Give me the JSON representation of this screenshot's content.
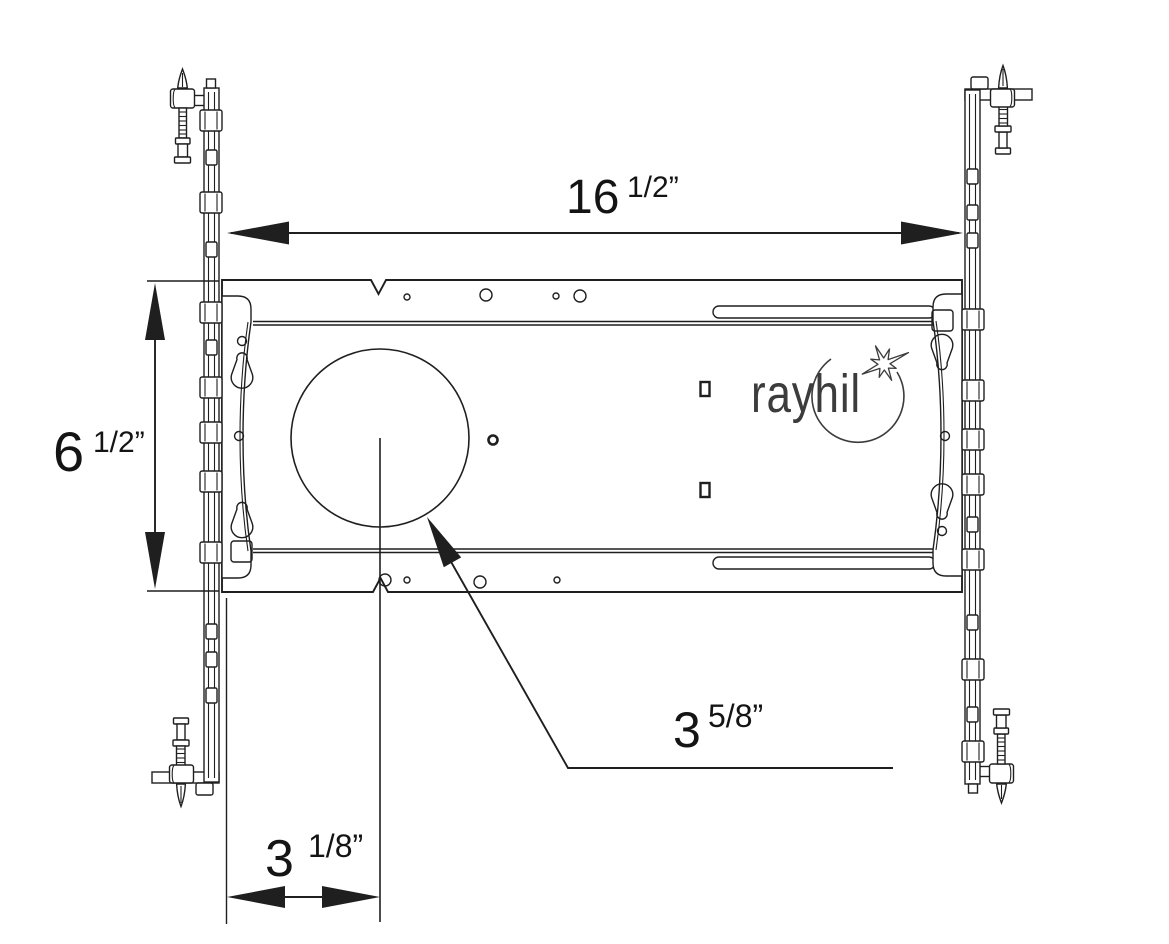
{
  "diagram": {
    "type": "technical-drawing",
    "brand_logo": {
      "text": "rayhil",
      "icon": "sparkle-burst-icon"
    },
    "dimensions": [
      {
        "id": "plate-width",
        "whole": "16",
        "fraction": "1/2”",
        "inches": 16.5
      },
      {
        "id": "plate-height",
        "whole": "6",
        "fraction": "1/2”",
        "inches": 6.5
      },
      {
        "id": "cutout-diameter",
        "whole": "3",
        "fraction": "5/8”",
        "inches": 3.625
      },
      {
        "id": "cutout-center-offset",
        "whole": "3",
        "fraction": "1/8”",
        "inches": 3.125
      }
    ],
    "colors": {
      "line": "#1f1f1f",
      "background": "#ffffff",
      "logo": "#3c3c3c"
    }
  }
}
